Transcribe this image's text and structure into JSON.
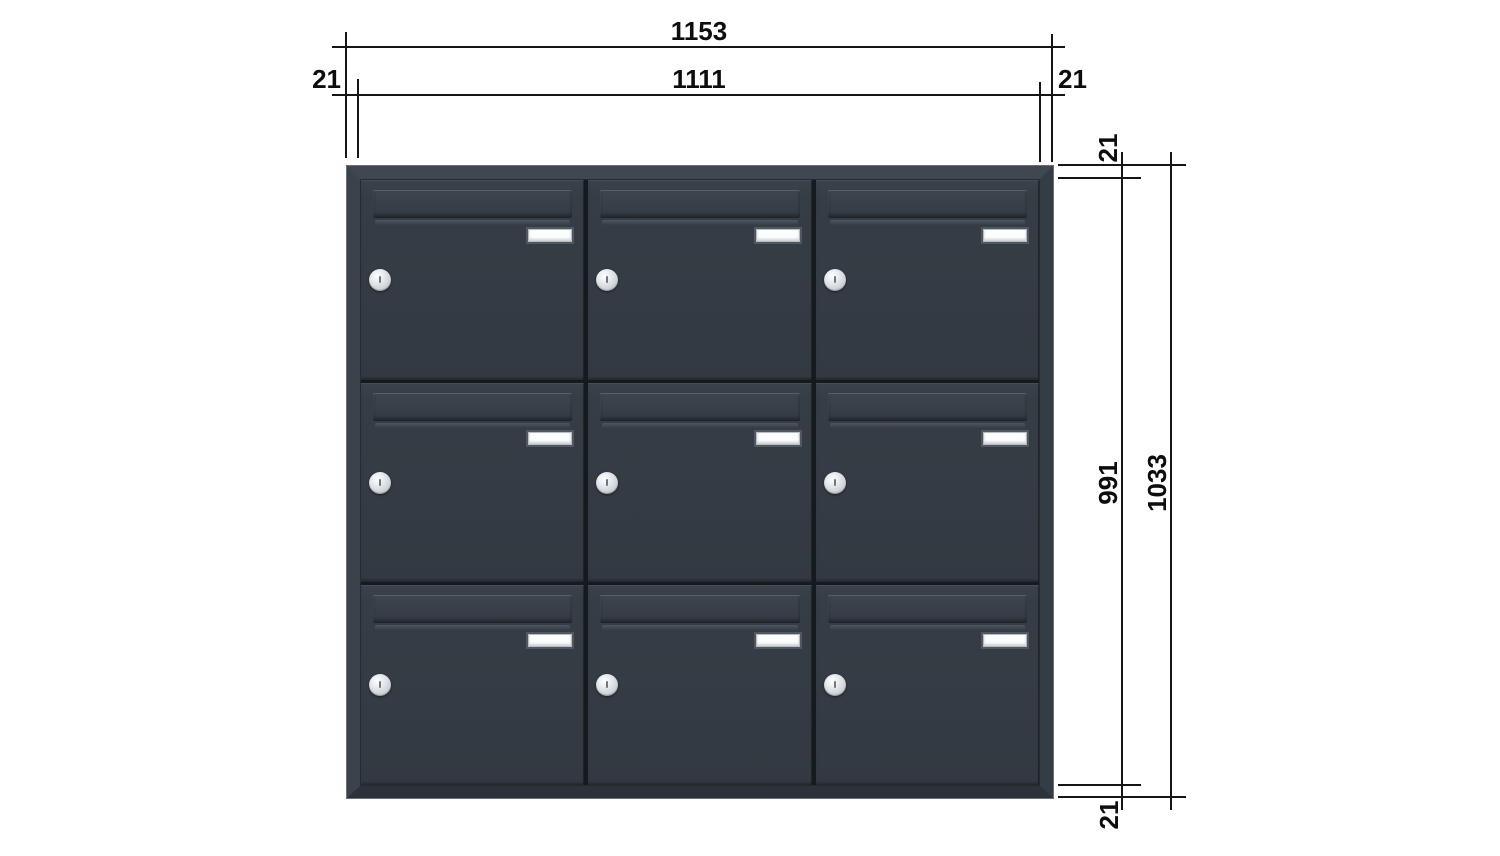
{
  "drawing": {
    "type": "technical-product-drawing",
    "unit_hint": "mm",
    "line_color": "#151515",
    "text_color": "#0d0d0d",
    "background": "#ffffff"
  },
  "dims": {
    "overall_width": "1153",
    "inner_width": "1111",
    "left_offset": "21",
    "right_offset": "21",
    "top_offset": "21",
    "inner_height": "991",
    "overall_height": "1033",
    "bottom_offset": "21"
  },
  "cabinet": {
    "rows": 3,
    "cols": 3,
    "door_count": 9,
    "colors": {
      "door_anthracite": "#343b44",
      "frame": "#39414a",
      "panel_gap": "#151a1f",
      "nameplate": "#fcfdfd",
      "lock_silver": "#d9dde0"
    },
    "parts": {
      "flap": "letter-slot-flap",
      "nameplate": "name-plate",
      "lock": "cylinder-lock"
    }
  }
}
